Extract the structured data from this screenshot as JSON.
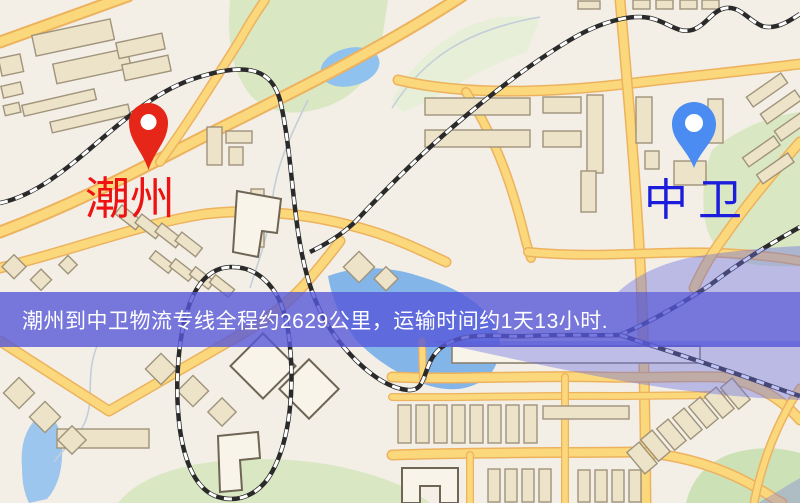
{
  "banner": {
    "text": "潮州到中卫物流专线全程约2629公里，运输时间约1天13小时."
  },
  "origin": {
    "label": "潮州"
  },
  "destination": {
    "label": "中卫"
  },
  "icons": {
    "origin_pin": "map-pin-icon",
    "destination_pin": "map-pin-icon"
  },
  "colors": {
    "banner-bg": "rgba(86,88,216,0.8)",
    "banner-text": "#ffffff",
    "origin-pin": "#e62619",
    "origin-label": "#ee1212",
    "dest-pin": "#4b8cf2",
    "dest-label": "#1c1cdc",
    "map-base": "#f3efe6",
    "road-fill": "#fbd87c",
    "road-casing": "#edb25e",
    "green-area": "#d9e7c3",
    "water": "#8fc2ee",
    "building-fill": "#ece3c8",
    "railway": "#2a2a2a"
  }
}
